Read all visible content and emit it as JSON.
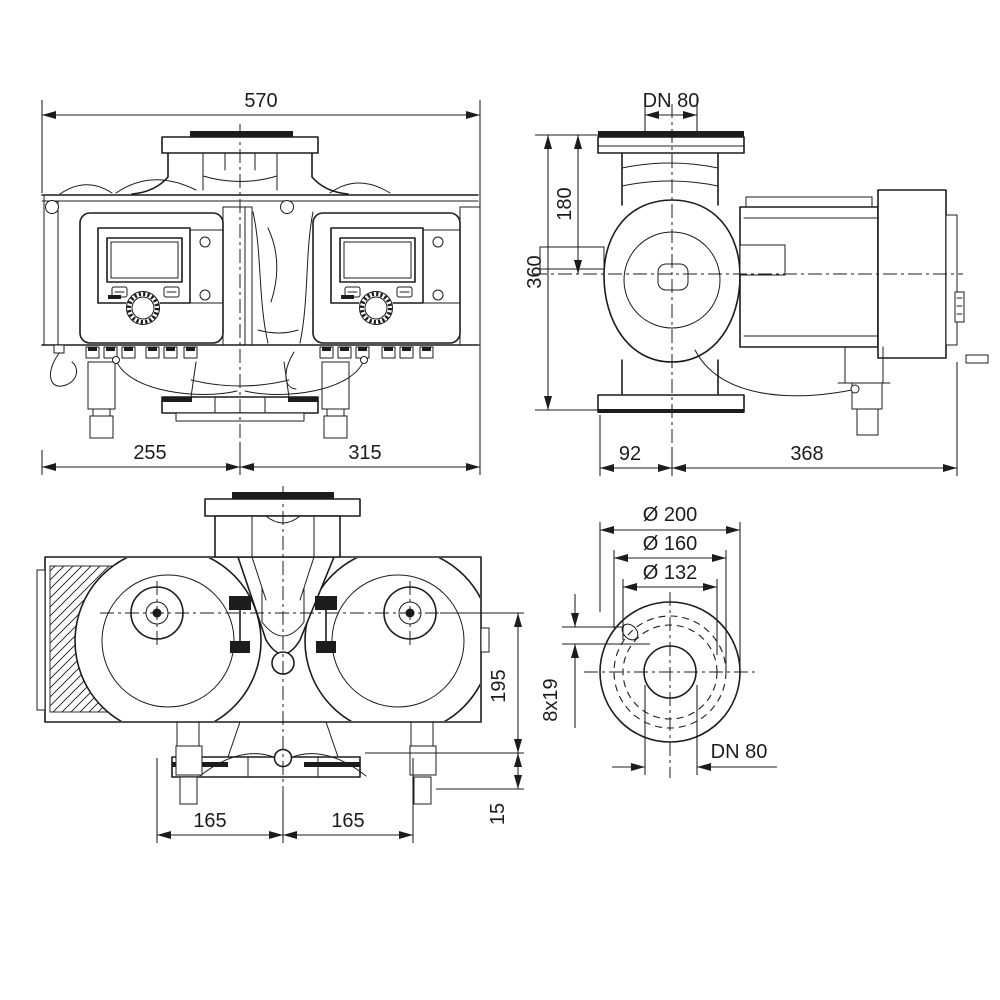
{
  "page": {
    "background_color": "#ffffff",
    "line_color": "#1c1c1c",
    "drawing_type": "twin-head pump dimensional drawing"
  },
  "views": {
    "front": {
      "label_overall_width": "570",
      "label_left_span": "255",
      "label_right_span": "315"
    },
    "side": {
      "label_flange_dn": "DN 80",
      "label_overall_height": "360",
      "label_flange_to_axis": "180",
      "label_flange_face_to_axis": "92",
      "label_axis_to_module_end": "368"
    },
    "bottom": {
      "label_axis_to_base": "195",
      "label_base_to_foot": "15",
      "label_center_to_left_axis": "165",
      "label_center_to_right_axis": "165"
    },
    "flange": {
      "label_outer_diameter": "Ø 200",
      "label_bolt_circle_diameter": "Ø 160",
      "label_raised_face_diameter": "Ø 132",
      "label_bolt_holes": "8x19",
      "label_nominal_bore": "DN 80"
    }
  }
}
